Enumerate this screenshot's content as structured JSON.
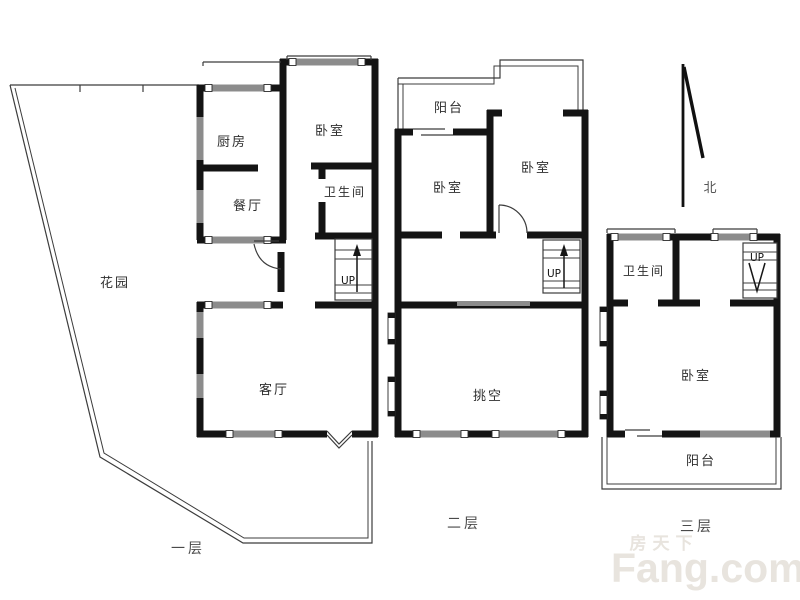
{
  "floors": [
    {
      "id": "floor-1",
      "label": "一层",
      "rooms": [
        {
          "key": "kitchen",
          "label": "厨房"
        },
        {
          "key": "bedroom",
          "label": "卧室"
        },
        {
          "key": "bathroom",
          "label": "卫生间"
        },
        {
          "key": "dining",
          "label": "餐厅"
        },
        {
          "key": "garden",
          "label": "花园"
        },
        {
          "key": "living-room",
          "label": "客厅"
        }
      ],
      "stairs": {
        "label": "UP",
        "direction": "up"
      }
    },
    {
      "id": "floor-2",
      "label": "二层",
      "rooms": [
        {
          "key": "balcony",
          "label": "阳台"
        },
        {
          "key": "bedroom-left",
          "label": "卧室"
        },
        {
          "key": "bedroom-right",
          "label": "卧室"
        },
        {
          "key": "void",
          "label": "挑空"
        }
      ],
      "stairs": {
        "label": "UP",
        "direction": "up"
      }
    },
    {
      "id": "floor-3",
      "label": "三层",
      "rooms": [
        {
          "key": "bathroom",
          "label": "卫生间"
        },
        {
          "key": "bedroom",
          "label": "卧室"
        },
        {
          "key": "balcony",
          "label": "阳台"
        }
      ],
      "stairs": {
        "label": "UP",
        "direction": "down"
      }
    }
  ],
  "compass": {
    "label": "北"
  },
  "watermark": {
    "cn": "房天下",
    "en": "Fang.com"
  },
  "colors": {
    "background": "#ffffff",
    "wall": "#141414",
    "window": "#8c8c8c",
    "thin_line": "#3c3c3c",
    "room_label": "#2e2e2e",
    "floor_label": "#4a4a4a",
    "compass_label": "#555555",
    "watermark": "#e8e4de"
  }
}
